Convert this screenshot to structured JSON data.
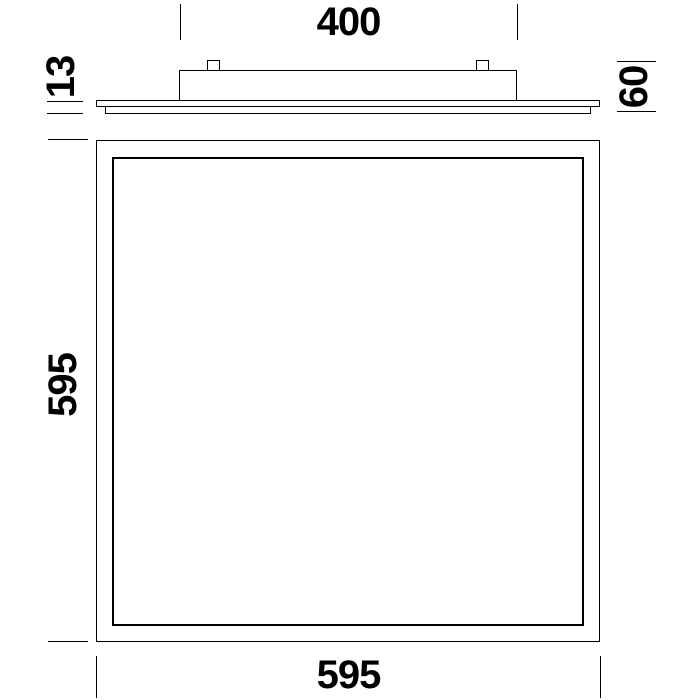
{
  "drawing": {
    "side_view": {
      "driver_box_width_mm": "400",
      "panel_thickness_mm": "13",
      "total_height_mm": "60"
    },
    "front_view": {
      "panel_height_mm": "595",
      "panel_width_mm": "595"
    }
  },
  "colors": {
    "line": "#000000",
    "text": "#000000",
    "background": "#ffffff"
  }
}
